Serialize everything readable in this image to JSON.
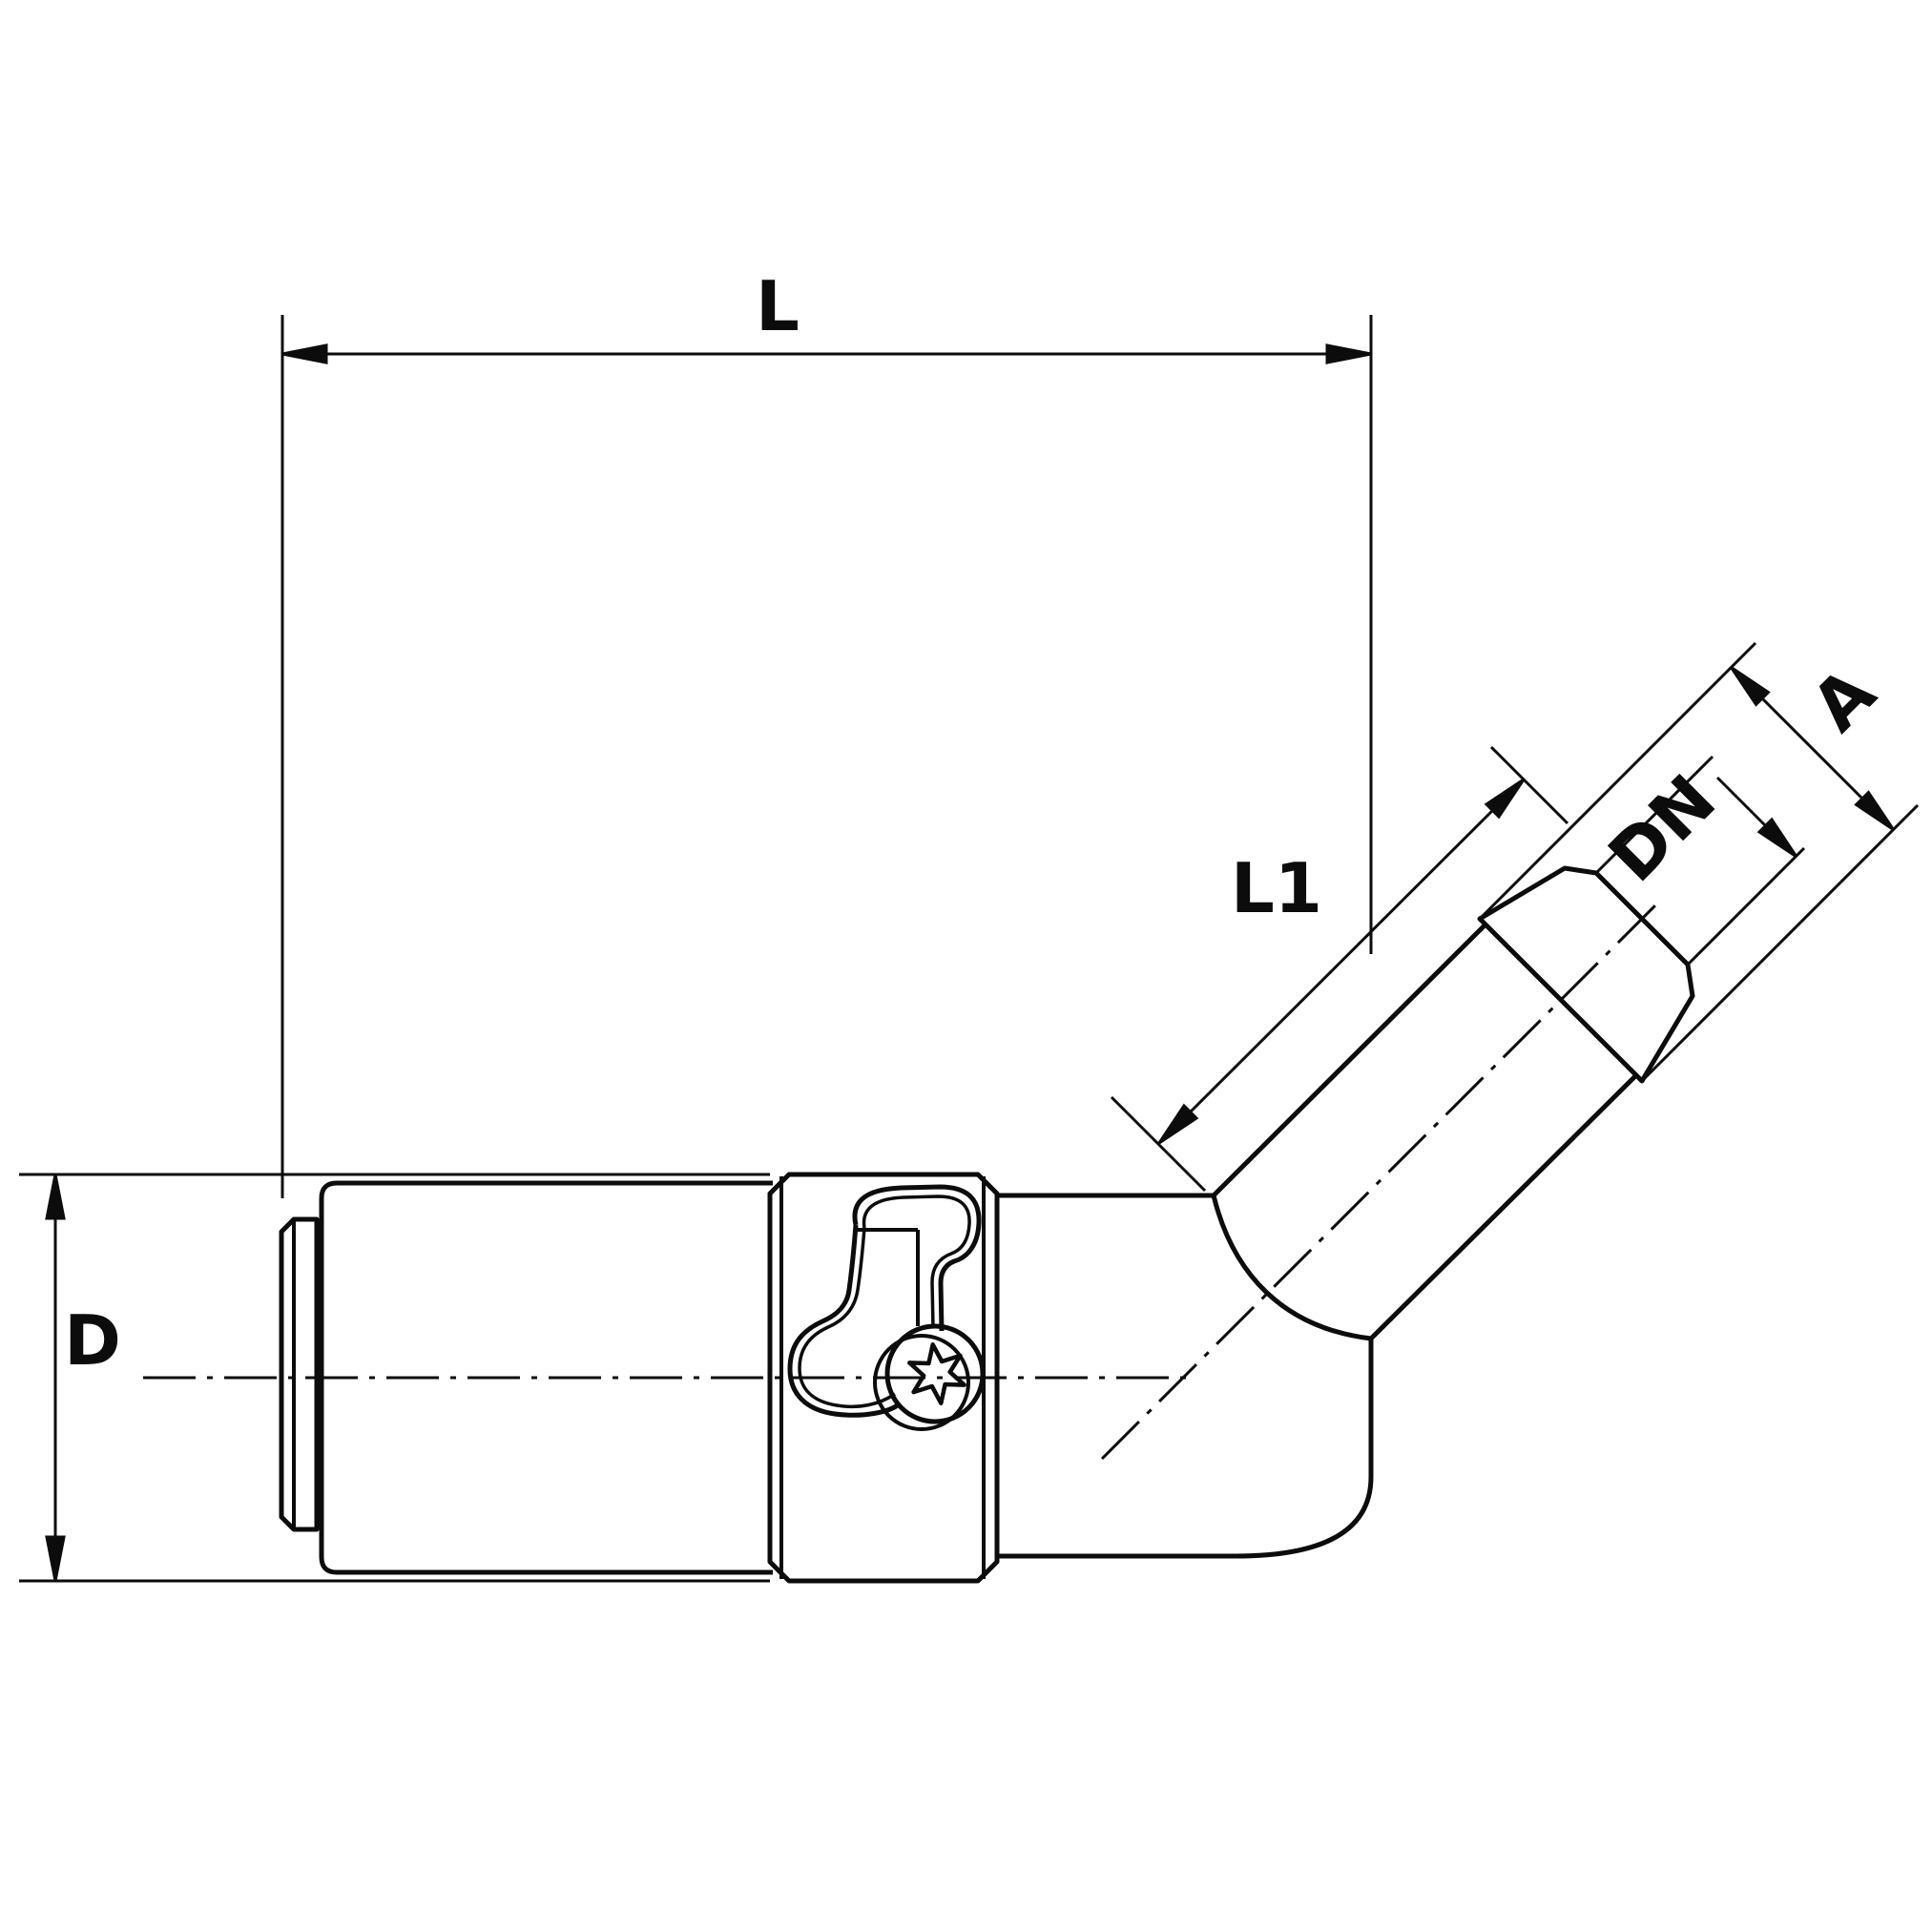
{
  "drawing": {
    "type": "technical-dimension-drawing",
    "subject": "45-degree angled hose coupling fitting, side view",
    "colors": {
      "line": "#0c0c0c",
      "background": "#ffffff"
    },
    "labels": {
      "overall_length": "L",
      "body_diameter": "D",
      "branch_length": "L1",
      "barb_outer_diameter": "A",
      "nominal_bore": "DN"
    }
  }
}
